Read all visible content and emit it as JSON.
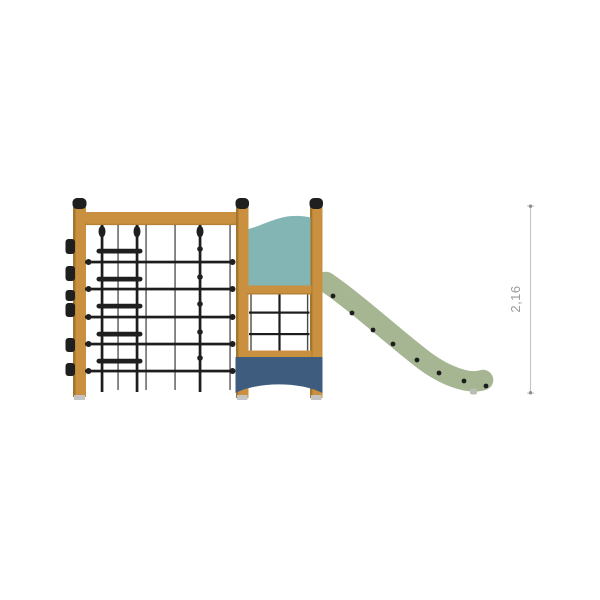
{
  "dimension": {
    "value": "2,16"
  },
  "colors": {
    "background": "#ffffff",
    "wood": "#c9913f",
    "wood_shadow": "#a4762d",
    "cap_black": "#1f1f1f",
    "rope": "#1d1d1d",
    "teal_panel": "#83b5b4",
    "navy_panel": "#3d5c7e",
    "slide_green": "#a6b692",
    "slide_foot_gray": "#b9bdb3",
    "post_foot_gray": "#c4c4c4",
    "dimension_line": "#c6c6c6",
    "dimension_tick": "#8e8e8e",
    "dimension_text": "#9a9a9a"
  },
  "icons": {
    "structure": "playground-climbing-frame-side-view",
    "slide": "slide-profile",
    "dimension": "vertical-dimension-line"
  }
}
